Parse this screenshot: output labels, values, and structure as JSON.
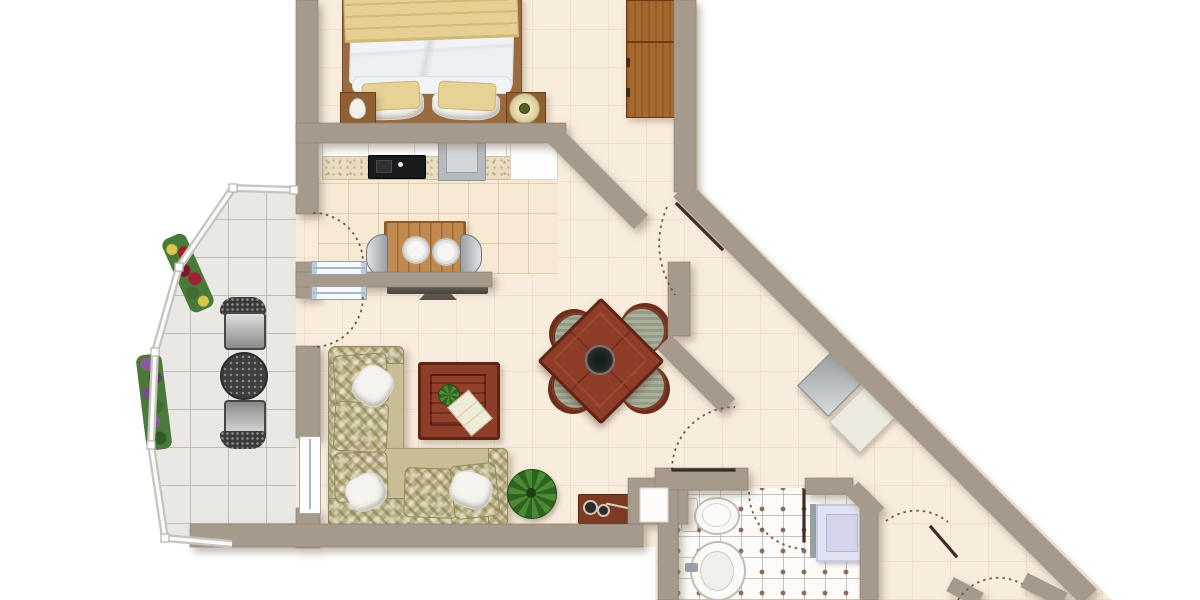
{
  "meta": {
    "type": "apartment-floor-plan",
    "width": 1200,
    "height": 600,
    "visible_text": "none"
  },
  "palette": {
    "outside": "#ffffff",
    "wall": "#a69a8c",
    "wall_edge": "#8a7e71",
    "floor_cream": "#f8ecdc",
    "floor_kitchen": "#f7e9d3",
    "floor_balcony": "#e9e8e5",
    "floor_bath": "#fcfbf9",
    "bath_dot": "#8a6a58",
    "door_arc": "#6b5a4e",
    "door_leaf": "#3f2d24",
    "window_glass": "#9fb8cc",
    "railing": "#c6c4c0",
    "railing_inner": "#fafaf8",
    "wood_dark_red": "#8e3d28",
    "wood_wardrobe": "#a5682f",
    "wood_kitchen_table": "#c08a4f",
    "fabric_olive": "#b8ae84",
    "fabric_tan": "#c9bd96",
    "pillow_white": "#f4f3ef",
    "bed_duvet": "#eef0f3",
    "bed_blanket": "#e5cf92",
    "metal_dark": "#3a3a3a",
    "appliance_gray": "#b6babf",
    "cooktop_black": "#191a1c",
    "shower_fill": "#e2e2f4",
    "plant_green": "#4c8a33",
    "flower_red": "#a02030",
    "flower_purple": "#7a4a8a"
  },
  "regions": {
    "bedroom": {
      "name": "bedroom",
      "furniture": [
        "double-bed",
        "nightstand-left",
        "nightstand-right",
        "table-lamp",
        "wardrobe"
      ]
    },
    "kitchen": {
      "name": "kitchen",
      "furniture": [
        "counter-cabinets",
        "cooktop-sink",
        "stove",
        "breakfast-table",
        "chair-left",
        "chair-right",
        "plates"
      ]
    },
    "living": {
      "name": "living-room",
      "furniture": [
        "corner-sofa",
        "throw-pillows",
        "coffee-table",
        "magazine",
        "potted-plant",
        "console",
        "tv"
      ]
    },
    "dining": {
      "name": "dining-area",
      "furniture": [
        "square-dining-table",
        "dining-chair-nw",
        "dining-chair-ne",
        "dining-chair-sw",
        "dining-chair-se",
        "center-bowl"
      ]
    },
    "balcony": {
      "name": "balcony",
      "furniture": [
        "bistro-chair-top",
        "bistro-chair-bottom",
        "mesh-table",
        "flower-box-upper",
        "flower-box-lower",
        "railing"
      ]
    },
    "hallway": {
      "name": "entrance-hall",
      "furniture": [
        "shoe-cabinet-gray",
        "shoe-cabinet-cream"
      ]
    },
    "bathroom": {
      "name": "bathroom",
      "furniture": [
        "toilet",
        "pedestal-sink",
        "shower-unit"
      ]
    }
  },
  "openings": {
    "doors": [
      "balcony-door-kitchen",
      "balcony-door-living",
      "bedroom-entry-door",
      "hall-living-door",
      "bathroom-door",
      "corridor-door",
      "corridor-door-lower"
    ],
    "windows": [
      "living-balcony-window"
    ]
  }
}
